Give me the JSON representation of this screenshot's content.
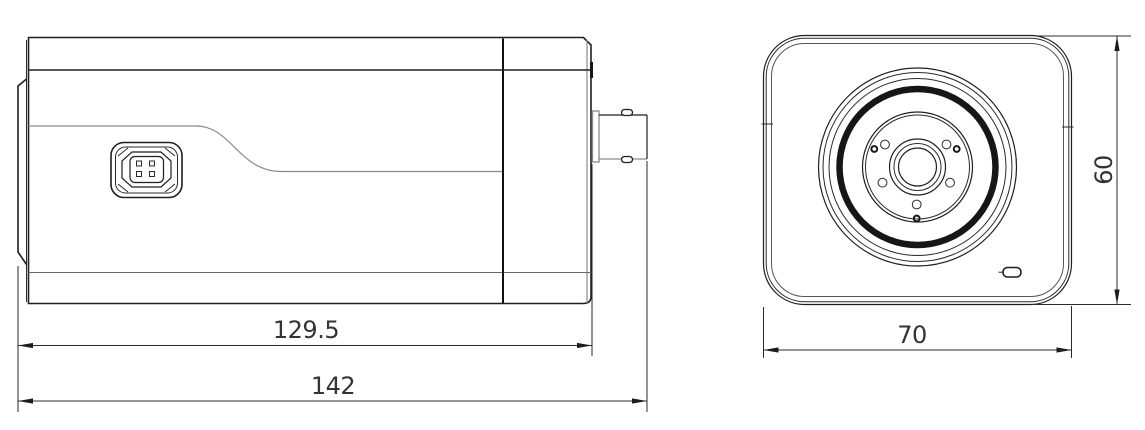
{
  "drawing": {
    "kind": "camera-dimension-drawing",
    "colors": {
      "background": "#ffffff",
      "line_primary": "#1f1f1f",
      "line_secondary": "#8c8c8c",
      "dimension": "#2b2b2b"
    },
    "views": {
      "side_view": "side-view",
      "front_view": "front-view"
    },
    "dimensions": {
      "side_body_length": "129.5",
      "side_total_length": "142",
      "front_width": "70",
      "front_height": "60"
    }
  }
}
